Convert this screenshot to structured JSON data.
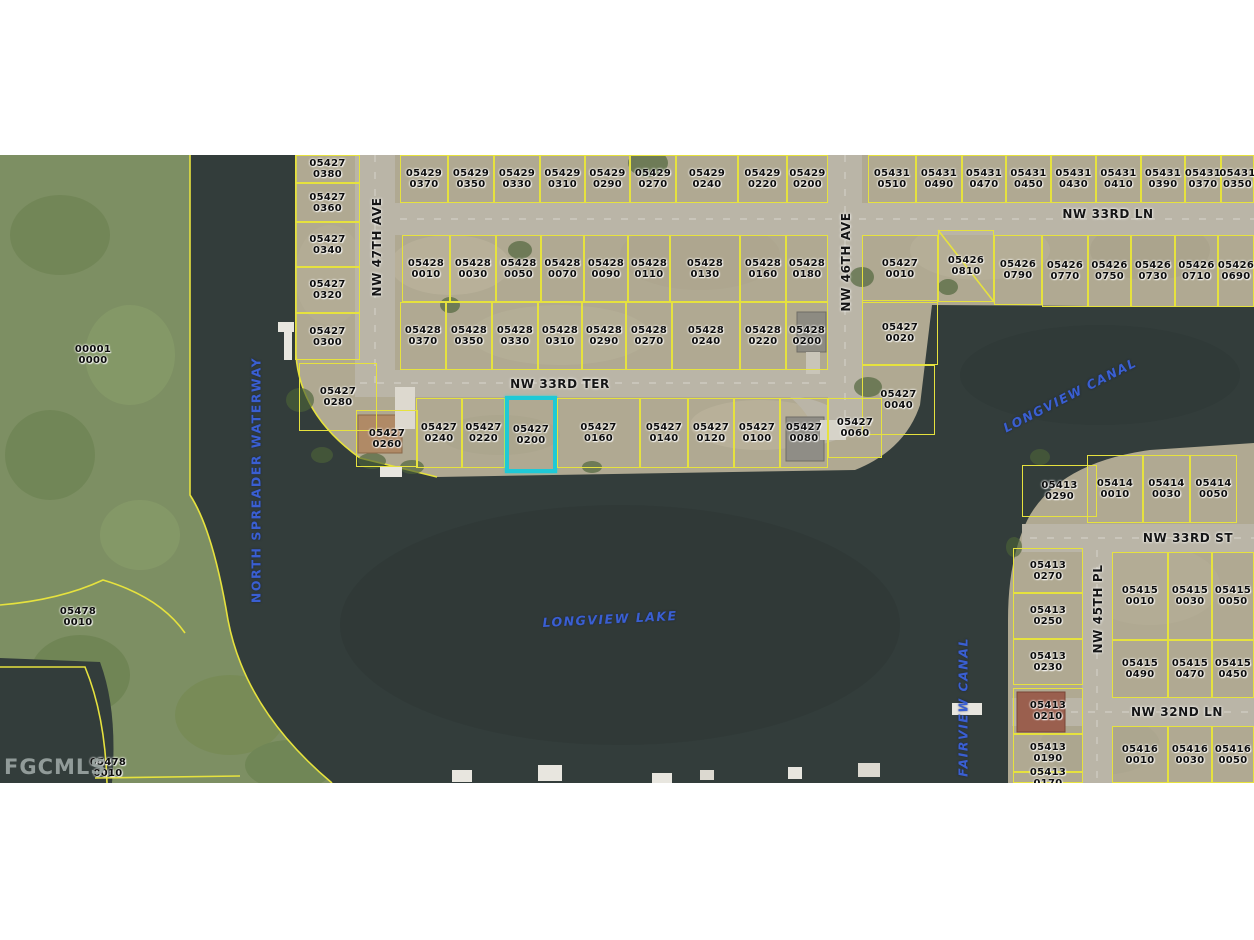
{
  "watermark": {
    "text": "FGCMLS"
  },
  "map": {
    "width": 1254,
    "top": 155,
    "height": 628,
    "colors": {
      "land": "#b0a992",
      "vegetation": "#7d8f63",
      "water": "#333d3b",
      "road": "#bab5a7",
      "lot_line": "#e6e23e",
      "highlight": "#1fc9d6",
      "water_text": "#3a5fd2"
    },
    "highlighted_parcel": "05427 0200",
    "parcels": [
      {
        "strap": "05427",
        "lot": "0380",
        "x": 295,
        "y": 0,
        "w": 65,
        "h": 28
      },
      {
        "strap": "05427",
        "lot": "0360",
        "x": 295,
        "y": 28,
        "w": 65,
        "h": 39
      },
      {
        "strap": "05427",
        "lot": "0340",
        "x": 295,
        "y": 67,
        "w": 65,
        "h": 45
      },
      {
        "strap": "05427",
        "lot": "0320",
        "x": 295,
        "y": 112,
        "w": 65,
        "h": 46
      },
      {
        "strap": "05427",
        "lot": "0300",
        "x": 295,
        "y": 158,
        "w": 65,
        "h": 47
      },
      {
        "strap": "05427",
        "lot": "0280",
        "x": 299,
        "y": 208,
        "w": 78,
        "h": 68
      },
      {
        "strap": "05427",
        "lot": "0260",
        "x": 356,
        "y": 255,
        "w": 62,
        "h": 57
      },
      {
        "strap": "05429",
        "lot": "0370",
        "x": 400,
        "y": 0,
        "w": 48,
        "h": 48
      },
      {
        "strap": "05429",
        "lot": "0350",
        "x": 448,
        "y": 0,
        "w": 46,
        "h": 48
      },
      {
        "strap": "05429",
        "lot": "0330",
        "x": 494,
        "y": 0,
        "w": 46,
        "h": 48
      },
      {
        "strap": "05429",
        "lot": "0310",
        "x": 540,
        "y": 0,
        "w": 45,
        "h": 48
      },
      {
        "strap": "05429",
        "lot": "0290",
        "x": 585,
        "y": 0,
        "w": 45,
        "h": 48
      },
      {
        "strap": "05429",
        "lot": "0270",
        "x": 630,
        "y": 0,
        "w": 46,
        "h": 48
      },
      {
        "strap": "05429",
        "lot": "0240",
        "x": 676,
        "y": 0,
        "w": 62,
        "h": 48
      },
      {
        "strap": "05429",
        "lot": "0220",
        "x": 738,
        "y": 0,
        "w": 49,
        "h": 48
      },
      {
        "strap": "05429",
        "lot": "0200",
        "x": 787,
        "y": 0,
        "w": 41,
        "h": 48
      },
      {
        "strap": "05431",
        "lot": "0510",
        "x": 868,
        "y": 0,
        "w": 48,
        "h": 48
      },
      {
        "strap": "05431",
        "lot": "0490",
        "x": 916,
        "y": 0,
        "w": 46,
        "h": 48
      },
      {
        "strap": "05431",
        "lot": "0470",
        "x": 962,
        "y": 0,
        "w": 44,
        "h": 48
      },
      {
        "strap": "05431",
        "lot": "0450",
        "x": 1006,
        "y": 0,
        "w": 45,
        "h": 48
      },
      {
        "strap": "05431",
        "lot": "0430",
        "x": 1051,
        "y": 0,
        "w": 45,
        "h": 48
      },
      {
        "strap": "05431",
        "lot": "0410",
        "x": 1096,
        "y": 0,
        "w": 45,
        "h": 48
      },
      {
        "strap": "05431",
        "lot": "0390",
        "x": 1141,
        "y": 0,
        "w": 44,
        "h": 48
      },
      {
        "strap": "05431",
        "lot": "0370",
        "x": 1185,
        "y": 0,
        "w": 36,
        "h": 48
      },
      {
        "strap": "05431",
        "lot": "0350",
        "x": 1221,
        "y": 0,
        "w": 33,
        "h": 48
      },
      {
        "strap": "05428",
        "lot": "0010",
        "x": 402,
        "y": 80,
        "w": 48,
        "h": 67
      },
      {
        "strap": "05428",
        "lot": "0030",
        "x": 450,
        "y": 80,
        "w": 46,
        "h": 67
      },
      {
        "strap": "05428",
        "lot": "0050",
        "x": 496,
        "y": 80,
        "w": 45,
        "h": 67
      },
      {
        "strap": "05428",
        "lot": "0070",
        "x": 541,
        "y": 80,
        "w": 43,
        "h": 67
      },
      {
        "strap": "05428",
        "lot": "0090",
        "x": 584,
        "y": 80,
        "w": 44,
        "h": 67
      },
      {
        "strap": "05428",
        "lot": "0110",
        "x": 628,
        "y": 80,
        "w": 42,
        "h": 67
      },
      {
        "strap": "05428",
        "lot": "0130",
        "x": 670,
        "y": 80,
        "w": 70,
        "h": 67
      },
      {
        "strap": "05428",
        "lot": "0160",
        "x": 740,
        "y": 80,
        "w": 46,
        "h": 67
      },
      {
        "strap": "05428",
        "lot": "0180",
        "x": 786,
        "y": 80,
        "w": 42,
        "h": 67
      },
      {
        "strap": "05427",
        "lot": "0010",
        "x": 862,
        "y": 80,
        "w": 76,
        "h": 68
      },
      {
        "strap": "05426",
        "lot": "0810",
        "x": 938,
        "y": 75,
        "w": 56,
        "h": 72
      },
      {
        "strap": "05426",
        "lot": "0790",
        "x": 994,
        "y": 80,
        "w": 48,
        "h": 70
      },
      {
        "strap": "05426",
        "lot": "0770",
        "x": 1042,
        "y": 80,
        "w": 46,
        "h": 72
      },
      {
        "strap": "05426",
        "lot": "0750",
        "x": 1088,
        "y": 80,
        "w": 43,
        "h": 72
      },
      {
        "strap": "05426",
        "lot": "0730",
        "x": 1131,
        "y": 80,
        "w": 44,
        "h": 72
      },
      {
        "strap": "05426",
        "lot": "0710",
        "x": 1175,
        "y": 80,
        "w": 43,
        "h": 72
      },
      {
        "strap": "05426",
        "lot": "0690",
        "x": 1218,
        "y": 80,
        "w": 36,
        "h": 72
      },
      {
        "strap": "05428",
        "lot": "0370",
        "x": 400,
        "y": 147,
        "w": 46,
        "h": 68
      },
      {
        "strap": "05428",
        "lot": "0350",
        "x": 446,
        "y": 147,
        "w": 46,
        "h": 68
      },
      {
        "strap": "05428",
        "lot": "0330",
        "x": 492,
        "y": 147,
        "w": 46,
        "h": 68
      },
      {
        "strap": "05428",
        "lot": "0310",
        "x": 538,
        "y": 147,
        "w": 44,
        "h": 68
      },
      {
        "strap": "05428",
        "lot": "0290",
        "x": 582,
        "y": 147,
        "w": 44,
        "h": 68
      },
      {
        "strap": "05428",
        "lot": "0270",
        "x": 626,
        "y": 147,
        "w": 46,
        "h": 68
      },
      {
        "strap": "05428",
        "lot": "0240",
        "x": 672,
        "y": 147,
        "w": 68,
        "h": 68
      },
      {
        "strap": "05428",
        "lot": "0220",
        "x": 740,
        "y": 147,
        "w": 46,
        "h": 68
      },
      {
        "strap": "05428",
        "lot": "0200",
        "x": 786,
        "y": 147,
        "w": 42,
        "h": 68
      },
      {
        "strap": "05427",
        "lot": "0020",
        "x": 862,
        "y": 145,
        "w": 76,
        "h": 65
      },
      {
        "strap": "05427",
        "lot": "0040",
        "x": 862,
        "y": 210,
        "w": 73,
        "h": 70
      },
      {
        "strap": "05427",
        "lot": "0240",
        "x": 416,
        "y": 243,
        "w": 46,
        "h": 70
      },
      {
        "strap": "05427",
        "lot": "0220",
        "x": 462,
        "y": 243,
        "w": 43,
        "h": 70
      },
      {
        "strap": "05427",
        "lot": "0200",
        "x": 505,
        "y": 241,
        "w": 52,
        "h": 77,
        "hl": true
      },
      {
        "strap": "05427",
        "lot": "0160",
        "x": 557,
        "y": 243,
        "w": 83,
        "h": 70
      },
      {
        "strap": "05427",
        "lot": "0140",
        "x": 640,
        "y": 243,
        "w": 48,
        "h": 70
      },
      {
        "strap": "05427",
        "lot": "0120",
        "x": 688,
        "y": 243,
        "w": 46,
        "h": 70
      },
      {
        "strap": "05427",
        "lot": "0100",
        "x": 734,
        "y": 243,
        "w": 46,
        "h": 70
      },
      {
        "strap": "05427",
        "lot": "0080",
        "x": 780,
        "y": 243,
        "w": 48,
        "h": 70
      },
      {
        "strap": "05427",
        "lot": "0060",
        "x": 828,
        "y": 243,
        "w": 54,
        "h": 60
      },
      {
        "strap": "05414",
        "lot": "0010",
        "x": 1087,
        "y": 300,
        "w": 56,
        "h": 68
      },
      {
        "strap": "05414",
        "lot": "0030",
        "x": 1143,
        "y": 300,
        "w": 47,
        "h": 68
      },
      {
        "strap": "05414",
        "lot": "0050",
        "x": 1190,
        "y": 300,
        "w": 47,
        "h": 68
      },
      {
        "strap": "05413",
        "lot": "0290",
        "x": 1022,
        "y": 310,
        "w": 75,
        "h": 52
      },
      {
        "strap": "05413",
        "lot": "0270",
        "x": 1013,
        "y": 393,
        "w": 70,
        "h": 45
      },
      {
        "strap": "05413",
        "lot": "0250",
        "x": 1013,
        "y": 438,
        "w": 70,
        "h": 46
      },
      {
        "strap": "05413",
        "lot": "0230",
        "x": 1013,
        "y": 484,
        "w": 70,
        "h": 46
      },
      {
        "strap": "05413",
        "lot": "0210",
        "x": 1013,
        "y": 533,
        "w": 70,
        "h": 46
      },
      {
        "strap": "05413",
        "lot": "0190",
        "x": 1013,
        "y": 579,
        "w": 70,
        "h": 38
      },
      {
        "strap": "05413",
        "lot": "0170",
        "x": 1013,
        "y": 617,
        "w": 70,
        "h": 11
      },
      {
        "strap": "05415",
        "lot": "0010",
        "x": 1112,
        "y": 397,
        "w": 56,
        "h": 88
      },
      {
        "strap": "05415",
        "lot": "0030",
        "x": 1168,
        "y": 397,
        "w": 44,
        "h": 88
      },
      {
        "strap": "05415",
        "lot": "0050",
        "x": 1212,
        "y": 397,
        "w": 42,
        "h": 88
      },
      {
        "strap": "05415",
        "lot": "0490",
        "x": 1112,
        "y": 485,
        "w": 56,
        "h": 58
      },
      {
        "strap": "05415",
        "lot": "0470",
        "x": 1168,
        "y": 485,
        "w": 44,
        "h": 58
      },
      {
        "strap": "05415",
        "lot": "0450",
        "x": 1212,
        "y": 485,
        "w": 42,
        "h": 58
      },
      {
        "strap": "05416",
        "lot": "0010",
        "x": 1112,
        "y": 571,
        "w": 56,
        "h": 57
      },
      {
        "strap": "05416",
        "lot": "0030",
        "x": 1168,
        "y": 571,
        "w": 44,
        "h": 57
      },
      {
        "strap": "05416",
        "lot": "0050",
        "x": 1212,
        "y": 571,
        "w": 42,
        "h": 57
      }
    ],
    "land_labels": [
      {
        "strap": "00001",
        "lot": "0000",
        "x": 93,
        "y": 200
      },
      {
        "strap": "05478",
        "lot": "0010",
        "x": 78,
        "y": 462
      },
      {
        "strap": "05478",
        "lot": "0010",
        "x": 108,
        "y": 613
      }
    ],
    "streets": [
      {
        "name": "NW 47TH AVE",
        "x": 377,
        "y": 92,
        "rotate": -90
      },
      {
        "name": "NW 33RD LN",
        "x": 1108,
        "y": 59,
        "rotate": 0
      },
      {
        "name": "NW 33RD TER",
        "x": 560,
        "y": 229,
        "rotate": 0
      },
      {
        "name": "NW 46TH AVE",
        "x": 846,
        "y": 107,
        "rotate": -90
      },
      {
        "name": "NW 33RD ST",
        "x": 1188,
        "y": 383,
        "rotate": 0
      },
      {
        "name": "NW 45TH PL",
        "x": 1098,
        "y": 454,
        "rotate": -90
      },
      {
        "name": "NW 32ND LN",
        "x": 1177,
        "y": 557,
        "rotate": 0
      }
    ],
    "water_labels": [
      {
        "name": "NORTH SPREADER WATERWAY",
        "x": 256,
        "y": 325,
        "rotate": -90,
        "italic": false
      },
      {
        "name": "LONGVIEW CANAL",
        "x": 1070,
        "y": 240,
        "rotate": -27,
        "italic": true
      },
      {
        "name": "LONGVIEW LAKE",
        "x": 610,
        "y": 464,
        "rotate": -3,
        "italic": true
      },
      {
        "name": "FAIRVIEW CANAL",
        "x": 963,
        "y": 552,
        "rotate": -90,
        "italic": true
      }
    ]
  }
}
